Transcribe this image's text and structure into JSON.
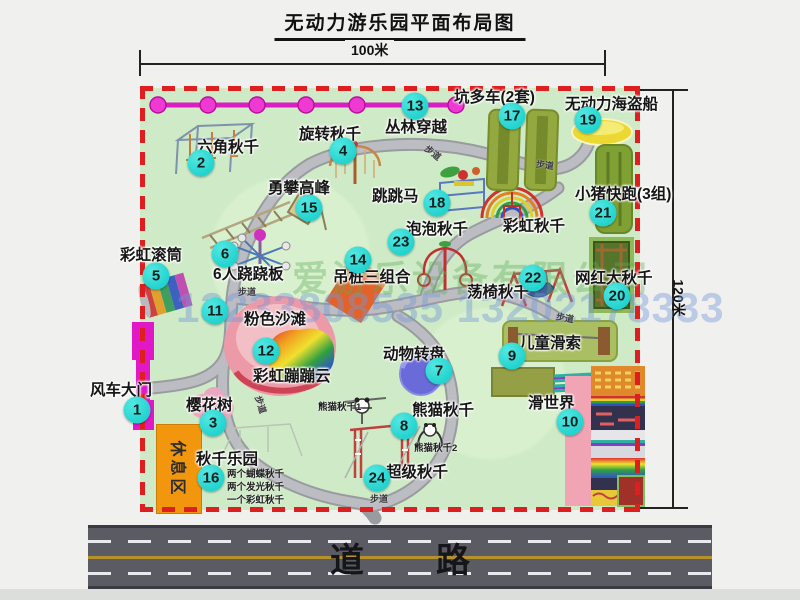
{
  "title": "无动力游乐园平面布局图",
  "dimensions": {
    "top": "100米",
    "right": "120米"
  },
  "road": {
    "label": "道路"
  },
  "watermark": {
    "company": "爱游乐设备有限公司",
    "phone": "13233808535 13202178333"
  },
  "rest_area": {
    "label": "休息区"
  },
  "walkway_label": "步道",
  "walkways": [
    {
      "x": 424,
      "y": 146,
      "r": 38
    },
    {
      "x": 536,
      "y": 158,
      "r": 8
    },
    {
      "x": 238,
      "y": 285,
      "r": 0
    },
    {
      "x": 252,
      "y": 398,
      "r": 72
    },
    {
      "x": 556,
      "y": 311,
      "r": 10
    },
    {
      "x": 370,
      "y": 492,
      "r": 0
    }
  ],
  "attractions": [
    {
      "num": "1",
      "name": "风车大门",
      "marker": {
        "x": 137,
        "y": 410
      },
      "label": {
        "x": 90,
        "y": 378
      }
    },
    {
      "num": "2",
      "name": "六角秋千",
      "marker": {
        "x": 201,
        "y": 163
      },
      "label": {
        "x": 197,
        "y": 135
      }
    },
    {
      "num": "3",
      "name": "樱花树",
      "marker": {
        "x": 213,
        "y": 423
      },
      "label": {
        "x": 186,
        "y": 393
      }
    },
    {
      "num": "4",
      "name": "旋转秋千",
      "marker": {
        "x": 343,
        "y": 151
      },
      "label": {
        "x": 299,
        "y": 122
      }
    },
    {
      "num": "5",
      "name": "彩虹滚筒",
      "marker": {
        "x": 156,
        "y": 276
      },
      "label": {
        "x": 120,
        "y": 243
      }
    },
    {
      "num": "6",
      "name": "6人跷跷板",
      "marker": {
        "x": 225,
        "y": 254
      },
      "label": {
        "x": 213,
        "y": 262
      }
    },
    {
      "num": "7",
      "name": "动物转盘",
      "marker": {
        "x": 439,
        "y": 371
      },
      "label": {
        "x": 383,
        "y": 342
      }
    },
    {
      "num": "8",
      "name": "熊猫秋千",
      "marker": {
        "x": 404,
        "y": 426
      },
      "label": {
        "x": 412,
        "y": 398
      }
    },
    {
      "num": "9",
      "name": "儿童滑索",
      "marker": {
        "x": 512,
        "y": 356
      },
      "label": {
        "x": 519,
        "y": 331
      }
    },
    {
      "num": "10",
      "name": "滑世界",
      "marker": {
        "x": 570,
        "y": 422
      },
      "label": {
        "x": 528,
        "y": 391
      }
    },
    {
      "num": "11",
      "name": "粉色沙滩",
      "marker": {
        "x": 215,
        "y": 311
      },
      "label": {
        "x": 244,
        "y": 307
      }
    },
    {
      "num": "12",
      "name": "彩虹蹦蹦云",
      "marker": {
        "x": 266,
        "y": 351
      },
      "label": {
        "x": 253,
        "y": 364
      }
    },
    {
      "num": "13",
      "name": "丛林穿越",
      "marker": {
        "x": 415,
        "y": 106
      },
      "label": {
        "x": 385,
        "y": 115
      }
    },
    {
      "num": "14",
      "name": "吊桩三组合",
      "marker": {
        "x": 358,
        "y": 260
      },
      "label": {
        "x": 333,
        "y": 265
      }
    },
    {
      "num": "15",
      "name": "勇攀高峰",
      "marker": {
        "x": 309,
        "y": 208
      },
      "label": {
        "x": 268,
        "y": 176
      }
    },
    {
      "num": "16",
      "name": "秋千乐园",
      "marker": {
        "x": 211,
        "y": 478
      },
      "label": {
        "x": 196,
        "y": 447
      }
    },
    {
      "num": "17",
      "name": "坑多车(2套)",
      "marker": {
        "x": 512,
        "y": 116
      },
      "label": {
        "x": 454,
        "y": 85
      }
    },
    {
      "num": "18",
      "name": "跳跳马",
      "marker": {
        "x": 437,
        "y": 203
      },
      "label": {
        "x": 372,
        "y": 184
      }
    },
    {
      "num": "19",
      "name": "无动力海盗船",
      "marker": {
        "x": 588,
        "y": 120
      },
      "label": {
        "x": 565,
        "y": 92
      }
    },
    {
      "num": "20",
      "name": "网红大秋千",
      "marker": {
        "x": 617,
        "y": 296
      },
      "label": {
        "x": 575,
        "y": 266
      }
    },
    {
      "num": "21",
      "name": "小猪快跑(3组)",
      "marker": {
        "x": 603,
        "y": 213
      },
      "label": {
        "x": 575,
        "y": 182
      }
    },
    {
      "num": "22",
      "name": "荡椅秋千",
      "marker": {
        "x": 533,
        "y": 278
      },
      "label": {
        "x": 467,
        "y": 280
      }
    },
    {
      "num": "23",
      "name": "泡泡秋千",
      "marker": {
        "x": 401,
        "y": 242
      },
      "label": {
        "x": 406,
        "y": 217
      }
    },
    {
      "num": "24",
      "name": "超级秋千",
      "marker": {
        "x": 377,
        "y": 478
      },
      "label": {
        "x": 386,
        "y": 460
      }
    }
  ],
  "extra_labels": [
    {
      "text": "彩虹秋千",
      "x": 503,
      "y": 214
    }
  ],
  "notes": [
    {
      "text": "熊猫秋千1",
      "x": 318,
      "y": 399
    },
    {
      "text": "熊猫秋千2",
      "x": 414,
      "y": 440
    },
    {
      "text": "两个蝴蝶秋千",
      "x": 227,
      "y": 466
    },
    {
      "text": "两个发光秋千",
      "x": 227,
      "y": 479
    },
    {
      "text": "一个彩虹秋千",
      "x": 227,
      "y": 492
    }
  ],
  "colors": {
    "marker": "#22d3ce",
    "border": "#de1f1f",
    "park": "#cfeac6",
    "road": "#5b5b64",
    "gate": "#e018c8",
    "rest": "#f2960e"
  }
}
